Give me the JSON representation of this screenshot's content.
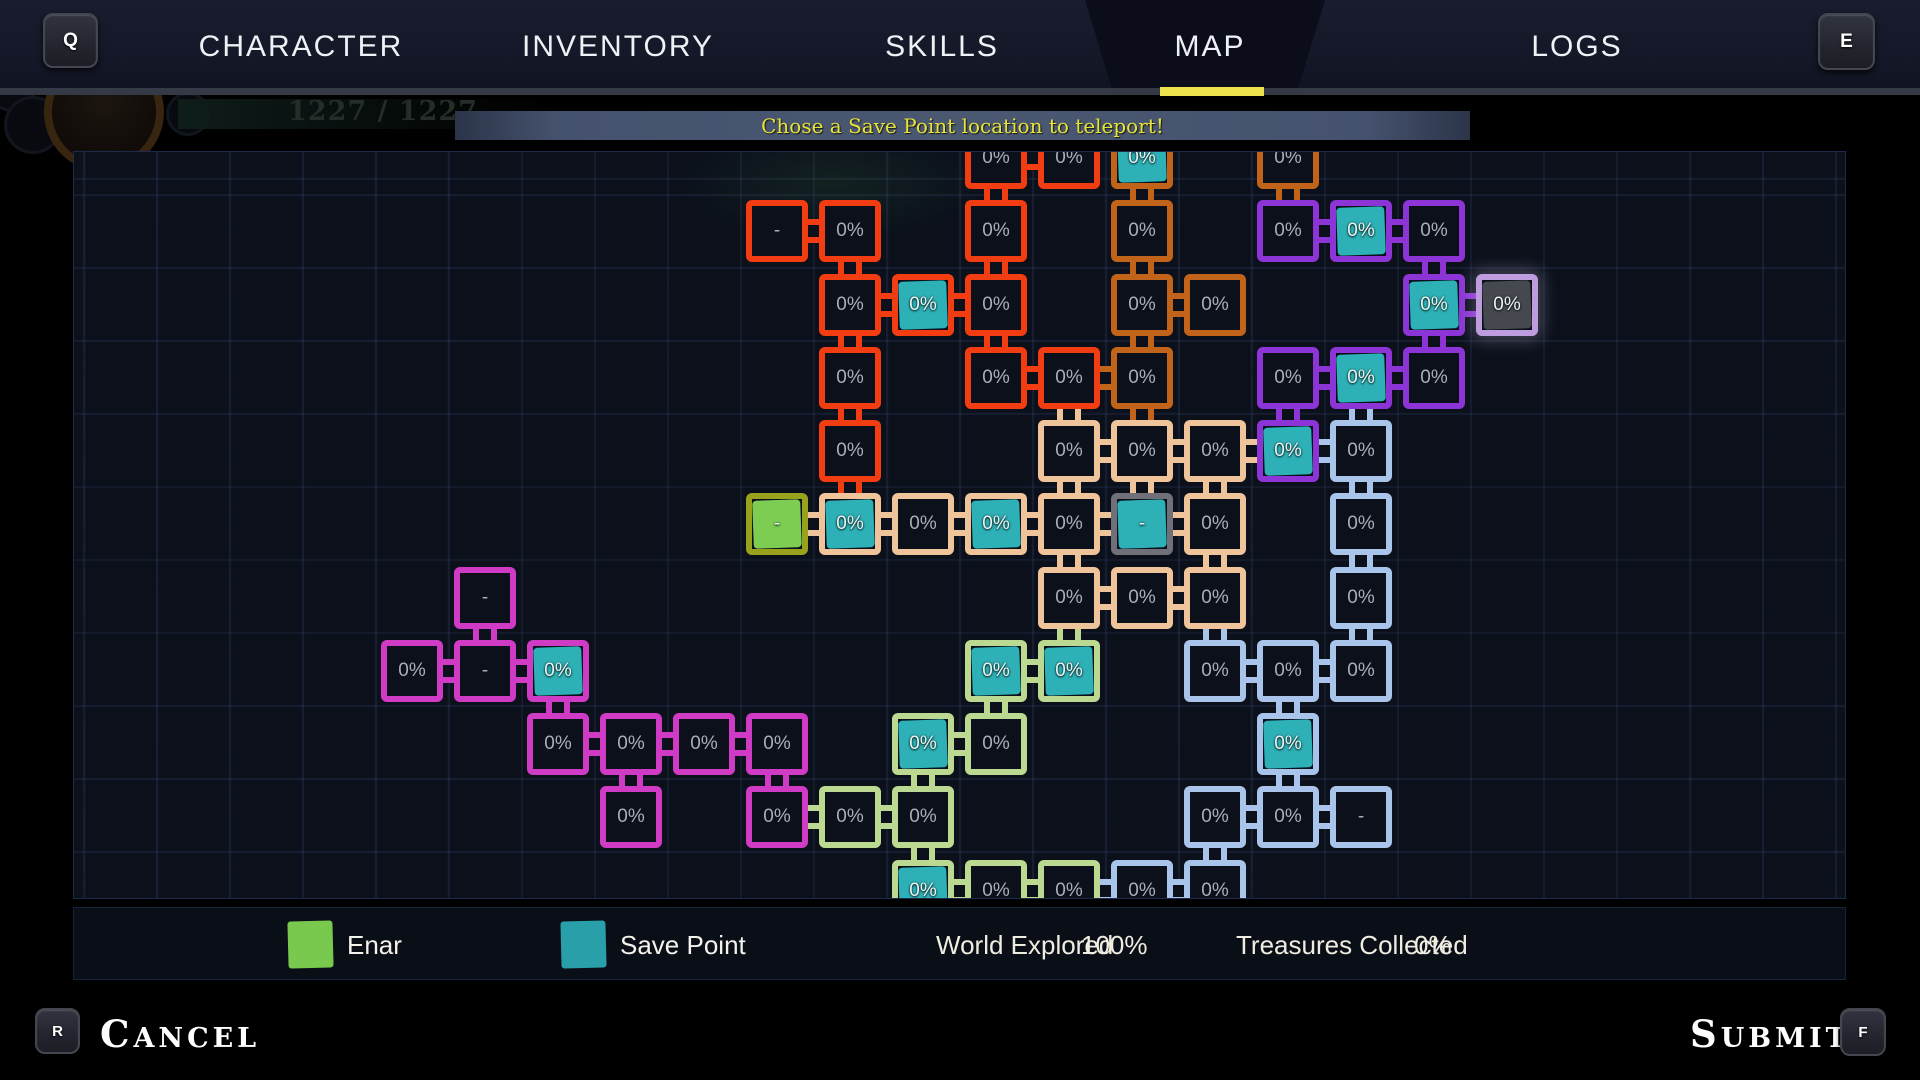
{
  "nav": {
    "left_key": "Q",
    "right_key": "E",
    "active_tab": "MAP",
    "tabs": [
      {
        "label": "CHARACTER",
        "x": 301
      },
      {
        "label": "INVENTORY",
        "x": 618
      },
      {
        "label": "SKILLS",
        "x": 942
      },
      {
        "label": "MAP",
        "x": 1210
      },
      {
        "label": "LOGS",
        "x": 1577
      }
    ]
  },
  "ghost_hud": {
    "hp": "1585 / 1585",
    "mp": "1227 / 1227"
  },
  "message": "Chose a Save Point location to teleport!",
  "map": {
    "palette": {
      "red": "#f23c12",
      "orange": "#c2631a",
      "purple": "#8c34d6",
      "pink": "#cf3bc4",
      "peach": "#f0c49b",
      "yellowgreen": "#bcd992",
      "blue": "#a9c4ea",
      "gray": "#70707a",
      "enar": "#99a21c",
      "selected": "#bd9ddd"
    },
    "fill_colors": {
      "teal": "#2db1b6",
      "green": "#7ccd52",
      "grayfill": "#45494f"
    },
    "rooms": [
      [
        8,
        0,
        "0%",
        "red",
        null
      ],
      [
        9,
        0,
        "0%",
        "red",
        null
      ],
      [
        10,
        0,
        "0%",
        "orange",
        "teal"
      ],
      [
        12,
        0,
        "0%",
        "orange",
        null
      ],
      [
        5,
        1,
        "-",
        "red",
        null
      ],
      [
        6,
        1,
        "0%",
        "red",
        null
      ],
      [
        8,
        1,
        "0%",
        "red",
        null
      ],
      [
        10,
        1,
        "0%",
        "orange",
        null
      ],
      [
        12,
        1,
        "0%",
        "purple",
        null
      ],
      [
        13,
        1,
        "0%",
        "purple",
        "teal"
      ],
      [
        14,
        1,
        "0%",
        "purple",
        null
      ],
      [
        6,
        2,
        "0%",
        "red",
        null
      ],
      [
        7,
        2,
        "0%",
        "red",
        "teal"
      ],
      [
        8,
        2,
        "0%",
        "red",
        null
      ],
      [
        10,
        2,
        "0%",
        "orange",
        null
      ],
      [
        11,
        2,
        "0%",
        "orange",
        null
      ],
      [
        14,
        2,
        "0%",
        "purple",
        "teal"
      ],
      [
        15,
        2,
        "0%",
        "selected",
        "grayfill"
      ],
      [
        6,
        3,
        "0%",
        "red",
        null
      ],
      [
        8,
        3,
        "0%",
        "red",
        null
      ],
      [
        9,
        3,
        "0%",
        "red",
        null
      ],
      [
        10,
        3,
        "0%",
        "orange",
        null
      ],
      [
        12,
        3,
        "0%",
        "purple",
        null
      ],
      [
        13,
        3,
        "0%",
        "purple",
        "teal"
      ],
      [
        14,
        3,
        "0%",
        "purple",
        null
      ],
      [
        6,
        4,
        "0%",
        "red",
        null
      ],
      [
        9,
        4,
        "0%",
        "peach",
        null
      ],
      [
        10,
        4,
        "0%",
        "peach",
        null
      ],
      [
        11,
        4,
        "0%",
        "peach",
        null
      ],
      [
        12,
        4,
        "0%",
        "purple",
        "teal"
      ],
      [
        13,
        4,
        "0%",
        "blue",
        null
      ],
      [
        5,
        5,
        "-",
        "enar",
        "green"
      ],
      [
        6,
        5,
        "0%",
        "peach",
        "teal"
      ],
      [
        7,
        5,
        "0%",
        "peach",
        null
      ],
      [
        8,
        5,
        "0%",
        "peach",
        "teal"
      ],
      [
        9,
        5,
        "0%",
        "peach",
        null
      ],
      [
        10,
        5,
        "-",
        "gray",
        "teal"
      ],
      [
        11,
        5,
        "0%",
        "peach",
        null
      ],
      [
        13,
        5,
        "0%",
        "blue",
        null
      ],
      [
        1,
        6,
        "-",
        "pink",
        null
      ],
      [
        9,
        6,
        "0%",
        "peach",
        null
      ],
      [
        10,
        6,
        "0%",
        "peach",
        null
      ],
      [
        11,
        6,
        "0%",
        "peach",
        null
      ],
      [
        13,
        6,
        "0%",
        "blue",
        null
      ],
      [
        0,
        7,
        "0%",
        "pink",
        null
      ],
      [
        1,
        7,
        "-",
        "pink",
        null
      ],
      [
        2,
        7,
        "0%",
        "pink",
        "teal"
      ],
      [
        8,
        7,
        "0%",
        "yellowgreen",
        "teal"
      ],
      [
        9,
        7,
        "0%",
        "yellowgreen",
        "teal"
      ],
      [
        11,
        7,
        "0%",
        "blue",
        null
      ],
      [
        12,
        7,
        "0%",
        "blue",
        null
      ],
      [
        13,
        7,
        "0%",
        "blue",
        null
      ],
      [
        2,
        8,
        "0%",
        "pink",
        null
      ],
      [
        3,
        8,
        "0%",
        "pink",
        null
      ],
      [
        4,
        8,
        "0%",
        "pink",
        null
      ],
      [
        5,
        8,
        "0%",
        "pink",
        null
      ],
      [
        7,
        8,
        "0%",
        "yellowgreen",
        "teal"
      ],
      [
        8,
        8,
        "0%",
        "yellowgreen",
        null
      ],
      [
        12,
        8,
        "0%",
        "blue",
        "teal"
      ],
      [
        3,
        9,
        "0%",
        "pink",
        null
      ],
      [
        5,
        9,
        "0%",
        "pink",
        null
      ],
      [
        6,
        9,
        "0%",
        "yellowgreen",
        null
      ],
      [
        7,
        9,
        "0%",
        "yellowgreen",
        null
      ],
      [
        11,
        9,
        "0%",
        "blue",
        null
      ],
      [
        12,
        9,
        "0%",
        "blue",
        null
      ],
      [
        13,
        9,
        "-",
        "blue",
        null
      ],
      [
        7,
        10,
        "0%",
        "yellowgreen",
        "teal"
      ],
      [
        8,
        10,
        "0%",
        "yellowgreen",
        null
      ],
      [
        9,
        10,
        "0%",
        "yellowgreen",
        null
      ],
      [
        10,
        10,
        "0%",
        "blue",
        null
      ],
      [
        11,
        10,
        "0%",
        "blue",
        null
      ]
    ],
    "connections": [
      [
        8,
        0,
        "h",
        "red"
      ],
      [
        8,
        0,
        "v",
        "red"
      ],
      [
        10,
        0,
        "v",
        "orange"
      ],
      [
        12,
        0,
        "v",
        "orange"
      ],
      [
        5,
        1,
        "h",
        "red"
      ],
      [
        6,
        1,
        "v",
        "red"
      ],
      [
        8,
        1,
        "v",
        "red"
      ],
      [
        10,
        1,
        "v",
        "orange"
      ],
      [
        12,
        1,
        "h",
        "purple"
      ],
      [
        13,
        1,
        "h",
        "purple"
      ],
      [
        14,
        1,
        "v",
        "purple"
      ],
      [
        6,
        2,
        "h",
        "red"
      ],
      [
        7,
        2,
        "h",
        "red"
      ],
      [
        6,
        2,
        "v",
        "red"
      ],
      [
        8,
        2,
        "v",
        "red"
      ],
      [
        10,
        2,
        "h",
        "orange"
      ],
      [
        10,
        2,
        "v",
        "orange"
      ],
      [
        14,
        2,
        "h",
        "purple"
      ],
      [
        14,
        2,
        "v",
        "purple"
      ],
      [
        8,
        3,
        "h",
        "red"
      ],
      [
        9,
        3,
        "h",
        "orange"
      ],
      [
        6,
        3,
        "v",
        "red"
      ],
      [
        9,
        3,
        "v",
        "peach"
      ],
      [
        10,
        3,
        "v",
        "orange"
      ],
      [
        12,
        3,
        "h",
        "purple"
      ],
      [
        13,
        3,
        "h",
        "purple"
      ],
      [
        12,
        3,
        "v",
        "purple"
      ],
      [
        13,
        3,
        "v",
        "blue"
      ],
      [
        6,
        4,
        "v",
        "red"
      ],
      [
        9,
        4,
        "h",
        "peach"
      ],
      [
        10,
        4,
        "h",
        "peach"
      ],
      [
        11,
        4,
        "h",
        "peach"
      ],
      [
        12,
        4,
        "h",
        "blue"
      ],
      [
        9,
        4,
        "v",
        "peach"
      ],
      [
        10,
        4,
        "v",
        "peach"
      ],
      [
        11,
        4,
        "v",
        "peach"
      ],
      [
        13,
        4,
        "v",
        "blue"
      ],
      [
        5,
        5,
        "h",
        "peach"
      ],
      [
        6,
        5,
        "h",
        "peach"
      ],
      [
        7,
        5,
        "h",
        "peach"
      ],
      [
        8,
        5,
        "h",
        "peach"
      ],
      [
        9,
        5,
        "h",
        "peach"
      ],
      [
        10,
        5,
        "h",
        "peach"
      ],
      [
        9,
        5,
        "v",
        "peach"
      ],
      [
        11,
        5,
        "v",
        "peach"
      ],
      [
        13,
        5,
        "v",
        "blue"
      ],
      [
        1,
        6,
        "v",
        "pink"
      ],
      [
        9,
        6,
        "h",
        "peach"
      ],
      [
        10,
        6,
        "h",
        "peach"
      ],
      [
        9,
        6,
        "v",
        "yellowgreen"
      ],
      [
        11,
        6,
        "v",
        "blue"
      ],
      [
        13,
        6,
        "v",
        "blue"
      ],
      [
        0,
        7,
        "h",
        "pink"
      ],
      [
        1,
        7,
        "h",
        "pink"
      ],
      [
        2,
        7,
        "v",
        "pink"
      ],
      [
        8,
        7,
        "h",
        "yellowgreen"
      ],
      [
        8,
        7,
        "v",
        "yellowgreen"
      ],
      [
        11,
        7,
        "h",
        "blue"
      ],
      [
        12,
        7,
        "h",
        "blue"
      ],
      [
        12,
        7,
        "v",
        "blue"
      ],
      [
        2,
        8,
        "h",
        "pink"
      ],
      [
        3,
        8,
        "h",
        "pink"
      ],
      [
        4,
        8,
        "h",
        "pink"
      ],
      [
        3,
        8,
        "v",
        "pink"
      ],
      [
        5,
        8,
        "v",
        "pink"
      ],
      [
        7,
        8,
        "h",
        "yellowgreen"
      ],
      [
        7,
        8,
        "v",
        "yellowgreen"
      ],
      [
        12,
        8,
        "v",
        "blue"
      ],
      [
        5,
        9,
        "h",
        "yellowgreen"
      ],
      [
        6,
        9,
        "h",
        "yellowgreen"
      ],
      [
        7,
        9,
        "v",
        "yellowgreen"
      ],
      [
        11,
        9,
        "h",
        "blue"
      ],
      [
        12,
        9,
        "h",
        "blue"
      ],
      [
        11,
        9,
        "v",
        "blue"
      ],
      [
        7,
        10,
        "h",
        "yellowgreen"
      ],
      [
        8,
        10,
        "h",
        "yellowgreen"
      ],
      [
        9,
        10,
        "h",
        "blue"
      ],
      [
        10,
        10,
        "h",
        "blue"
      ]
    ]
  },
  "legend": {
    "enar_label": "Enar",
    "save_label": "Save Point",
    "world_explored_label": "World Explored",
    "world_explored_value": "100%",
    "treasures_label": "Treasures Collected",
    "treasures_value": "0%"
  },
  "footer": {
    "cancel_key": "R",
    "cancel_label": "Cancel",
    "submit_label": "Submit",
    "submit_key": "F"
  }
}
